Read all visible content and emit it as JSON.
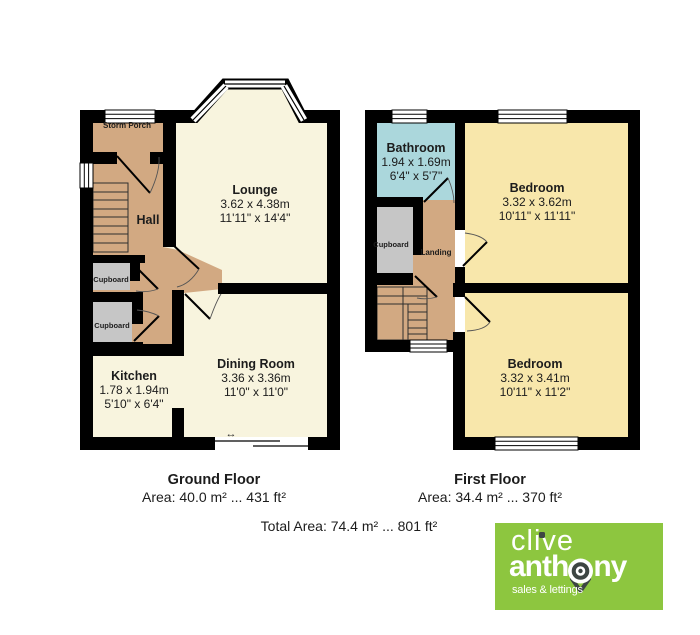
{
  "colors": {
    "wall": "#000000",
    "room": "#f8f4de",
    "bedroom": "#f8e7ab",
    "bathroom": "#abd7dc",
    "hall": "#d2a982",
    "cupboard": "#c6c6c6",
    "logo_green": "#8dc63f",
    "logo_dark": "#3d4543",
    "text": "#1c1c1c"
  },
  "icons": {
    "double_arrow": "↔"
  },
  "ground_floor": {
    "title": "Ground Floor",
    "area_line": "Area: 40.0 m² ... 431 ft²",
    "rooms": {
      "storm_porch": {
        "name": "Storm Porch"
      },
      "hall": {
        "name": "Hall"
      },
      "lounge": {
        "name": "Lounge",
        "metric": "3.62 x 4.38m",
        "imperial": "11'11\" x 14'4\""
      },
      "cupboard_top": {
        "name": "Cupboard"
      },
      "cupboard_bottom": {
        "name": "Cupboard"
      },
      "kitchen": {
        "name": "Kitchen",
        "metric": "1.78 x 1.94m",
        "imperial": "5'10\" x 6'4\""
      },
      "dining_room": {
        "name": "Dining Room",
        "metric": "3.36 x 3.36m",
        "imperial": "11'0\" x 11'0\""
      }
    }
  },
  "first_floor": {
    "title": "First Floor",
    "area_line": "Area: 34.4 m² ... 370 ft²",
    "rooms": {
      "bathroom": {
        "name": "Bathroom",
        "metric": "1.94 x 1.69m",
        "imperial": "6'4\" x 5'7\""
      },
      "bedroom_front": {
        "name": "Bedroom",
        "metric": "3.32 x 3.62m",
        "imperial": "10'11\" x 11'11\""
      },
      "cupboard": {
        "name": "Cupboard"
      },
      "landing": {
        "name": "Landing"
      },
      "bedroom_back": {
        "name": "Bedroom",
        "metric": "3.32 x 3.41m",
        "imperial": "10'11\" x 11'2\""
      }
    }
  },
  "summary": {
    "total_area": "Total Area: 74.4 m² ... 801 ft²"
  },
  "logo": {
    "line1": "clive",
    "line2_start": "anth",
    "line2_end": "ny",
    "tagline": "sales & lettings"
  }
}
